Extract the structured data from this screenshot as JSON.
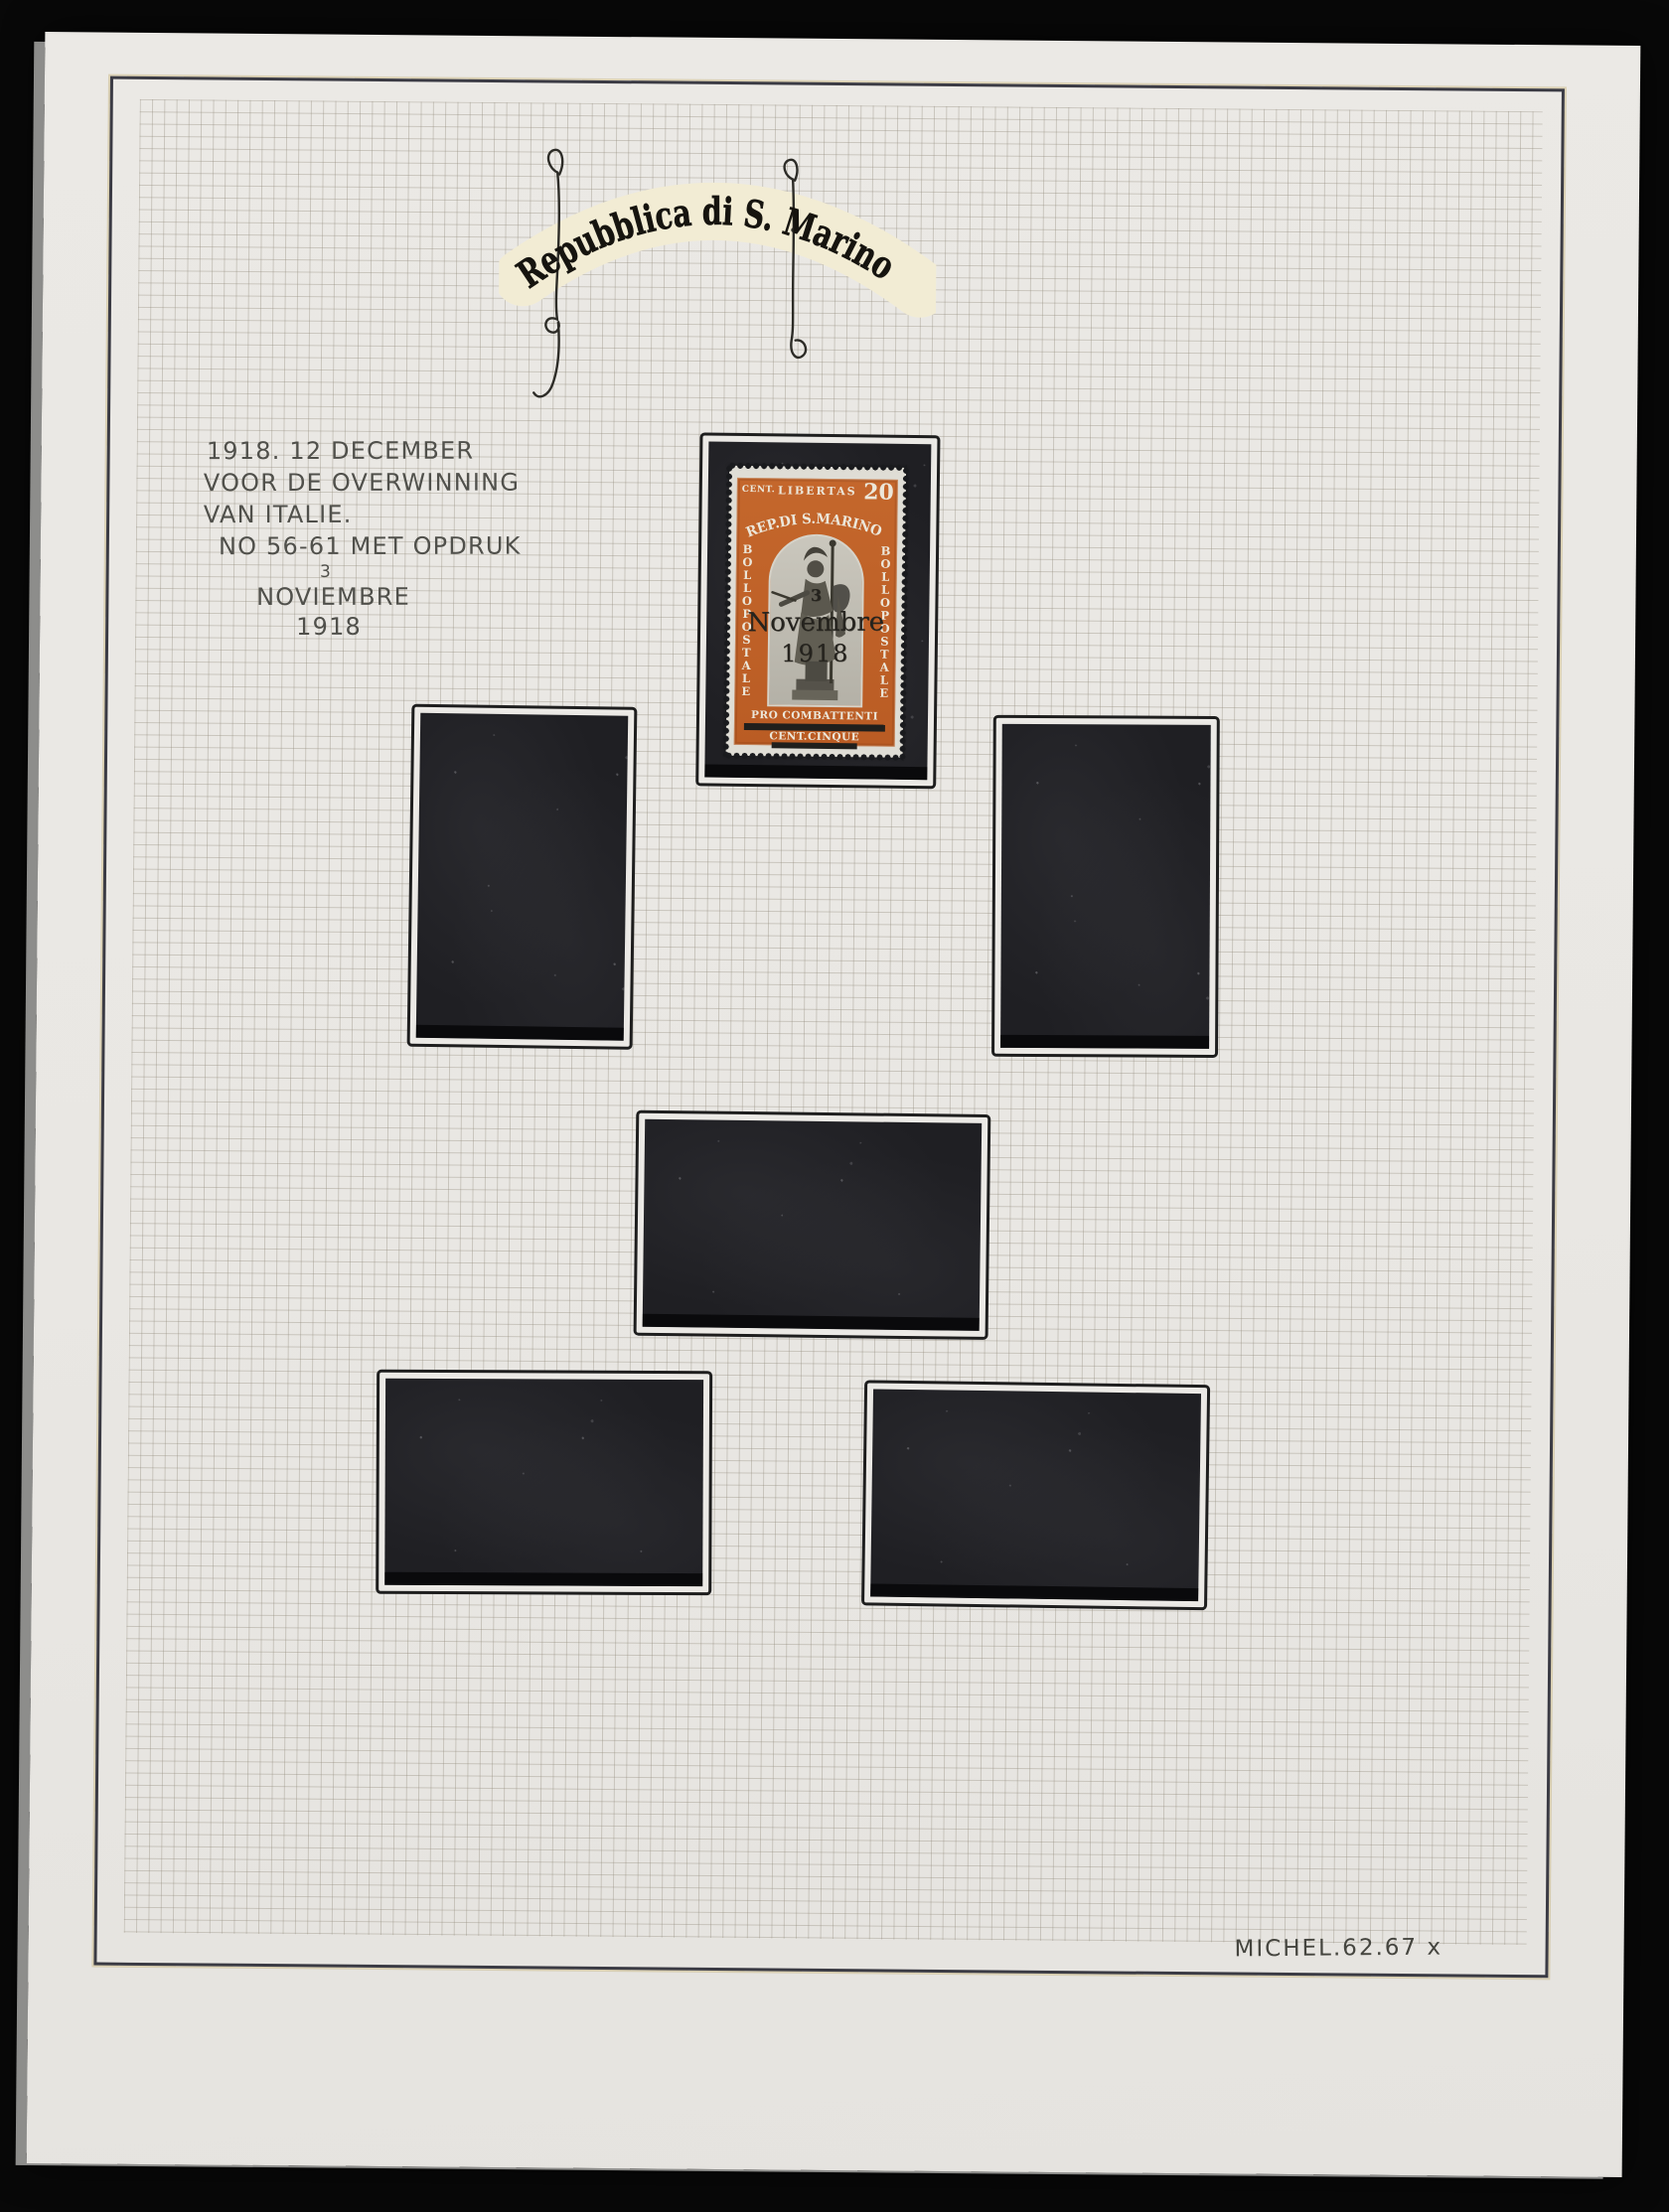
{
  "scene": {
    "kind": "photograph of a stamp album page",
    "background_color": "#080808",
    "paper_color": "#e9e7e3",
    "grid_color": "#928b7c",
    "frame_line_color": "#3b3b44",
    "mount_color": "#1f1f23",
    "mount_frame_ink": "#1e1e1e"
  },
  "header": {
    "title": "Repubblica di S. Marino",
    "highlight_color": "#f2ecd4",
    "ink_color": "#16140f"
  },
  "annotation": {
    "line1": "1918. 12 DECEMBER",
    "line2": "VOOR DE OVERWINNING",
    "line3": "VAN ITALIE.",
    "line4": "NO 56-61 MET OPDRUK",
    "sup": "3",
    "line5": "NOVIEMBRE",
    "line6": "1918"
  },
  "stamp": {
    "value_label": "CENT.",
    "motto": "LIBERTAS",
    "denomination": "20",
    "country": "REP.DI S.MARINO",
    "side_left": "BOLLO POSTALE",
    "side_right": "BOLLO POSTALE",
    "bottom_line1": "PRO COMBATTENTI",
    "bottom_line2": "CENT.CINQUE",
    "overprint_day": "3",
    "overprint_month": "Novembre",
    "overprint_year": "1918",
    "frame_color": "#bf6129",
    "vignette_color": "#c0bdb3",
    "paper_color": "#dfddd5"
  },
  "catalog_note": "MICHEL.62.67 x",
  "mounts": {
    "count": 5,
    "empty": true
  }
}
